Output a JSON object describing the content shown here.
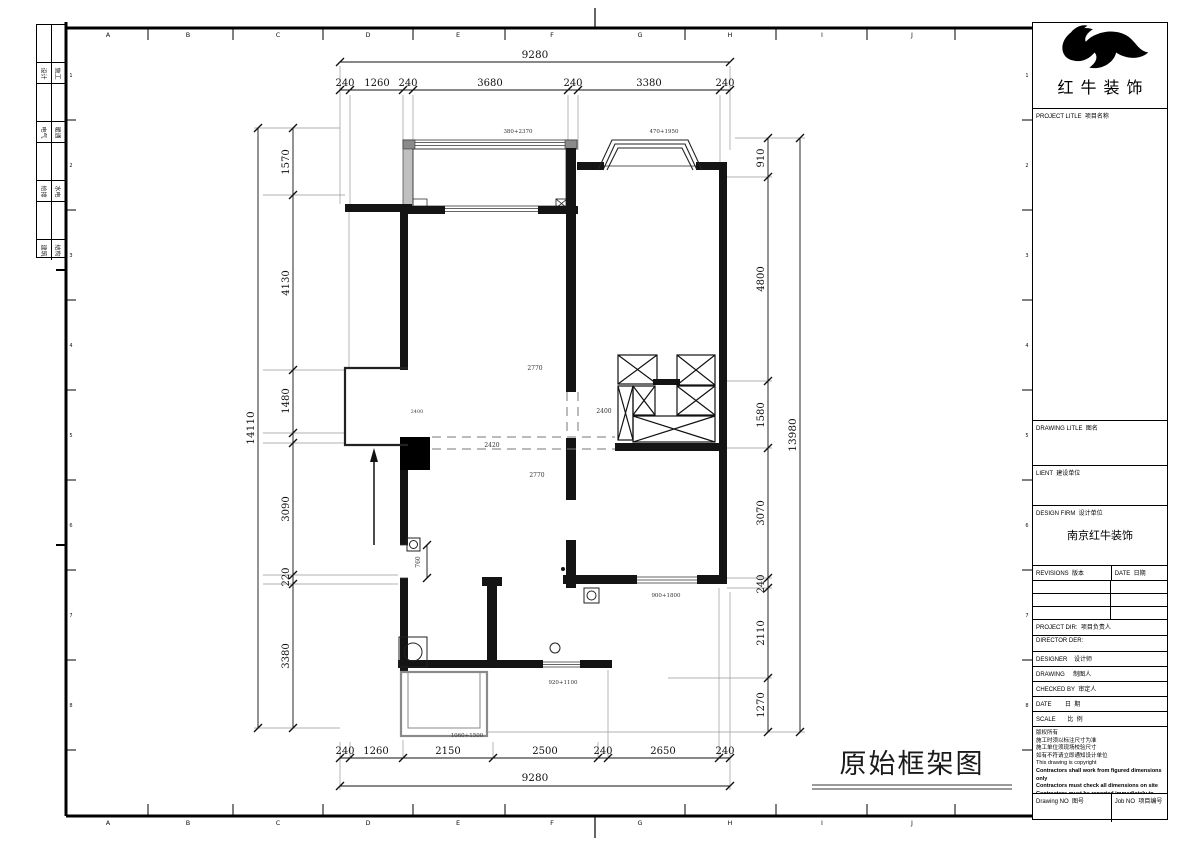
{
  "sheet": {
    "drawing_title": "原始框架图",
    "grid_letters": [
      "A",
      "B",
      "C",
      "D",
      "E",
      "F",
      "G",
      "H",
      "I",
      "J"
    ],
    "grid_numbers": [
      "1",
      "2",
      "3",
      "4",
      "5",
      "6",
      "7",
      "8"
    ],
    "signoff": [
      [
        "设计",
        "施工"
      ],
      [
        "电气",
        "暖通"
      ],
      [
        "给排",
        "水电"
      ],
      [
        "建筑",
        "结构"
      ]
    ]
  },
  "titleblock": {
    "company": "红牛装饰",
    "project_title_label": "PROJECT LITLE  项目名称",
    "drawing_title_label": "DRAWING LITLE  图名",
    "client_label": "LIENT  建设单位",
    "design_firm_label": "DESIGN FIRM  设计单位",
    "design_firm_value": "南京红牛装饰",
    "revisions_label": "REVISIONS  版本",
    "date_col_label": "DATE  日期",
    "project_dir_label": "PROJECT DIR:  项目负责人",
    "director_label": "DIRECTOR DER:",
    "designer_label": "DESIGNER    设计师",
    "drawing_by_label": "DRAWING     制图人",
    "checked_by_label": "CHECKED BY  审定人",
    "date_label": "DATE        日  期",
    "scale_label": "SCALE       比  例",
    "notes": [
      "版权所有",
      "施工时须以标注尺寸为准",
      "施工单位须现场校验尺寸",
      "如有不符请立即通知设计单位",
      "This drawing is copyright",
      "Contractors shall work from figured dimensions only",
      "Contractors must check all dimensions on site",
      "Contractors must be reported immediately to architects"
    ],
    "drawing_no_label": "Drawing NO  图号",
    "job_no_label": "Job NO  项目编号"
  },
  "plan": {
    "dims_top": {
      "overall": "9280",
      "segments": [
        "240",
        "1260",
        "240",
        "3680",
        "240",
        "3380",
        "240"
      ]
    },
    "dims_bottom": {
      "overall": "9280",
      "segments": [
        "240",
        "1260",
        "2150",
        "2500",
        "240",
        "2650",
        "240"
      ]
    },
    "dims_left": {
      "overall": "14110",
      "segments": [
        "1570",
        "4130",
        "1480",
        "3090",
        "220",
        "3380"
      ]
    },
    "dims_right": {
      "overall": "13980",
      "segments": [
        "910",
        "4800",
        "1580",
        "3070",
        "240",
        "2110",
        "1270"
      ]
    },
    "room_labels": [
      "2770",
      "2400",
      "2420",
      "2400",
      "2770",
      "760"
    ],
    "window_labels": [
      "380+2370",
      "470+1950",
      "900+1800",
      "920+1100",
      "1060+1500"
    ]
  }
}
